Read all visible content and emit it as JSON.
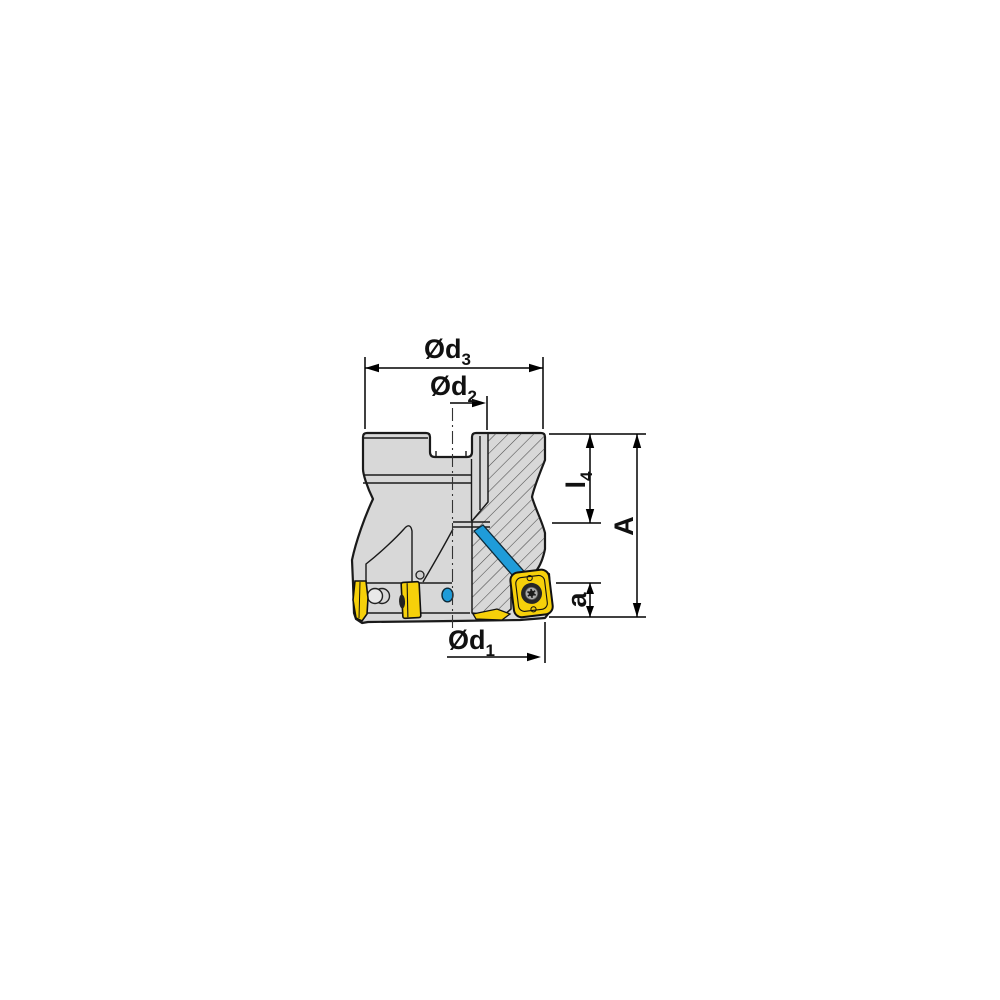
{
  "drawing": {
    "type": "technical drawing",
    "subject": "Indexable shoulder face milling cutter, side view with half cross-section, coolant channel and insert shown",
    "colors": {
      "background": "#ffffff",
      "body_gray": "#d8d8d8",
      "outline": "#1a1a1a",
      "hatch_line": "#4a4a4a",
      "insert_yellow": "#f6d00a",
      "coolant_blue": "#1f9cd9",
      "dimension_black": "#000000"
    },
    "labels": {
      "d3": {
        "text": "Ød",
        "sub": "3"
      },
      "d2": {
        "text": "Ød",
        "sub": "2"
      },
      "d1": {
        "text": "Ød",
        "sub": "1"
      },
      "l4": {
        "text": "l",
        "sub": "4"
      },
      "A": {
        "text": "A",
        "sub": ""
      },
      "a": {
        "text": "a",
        "sub": ""
      }
    }
  }
}
